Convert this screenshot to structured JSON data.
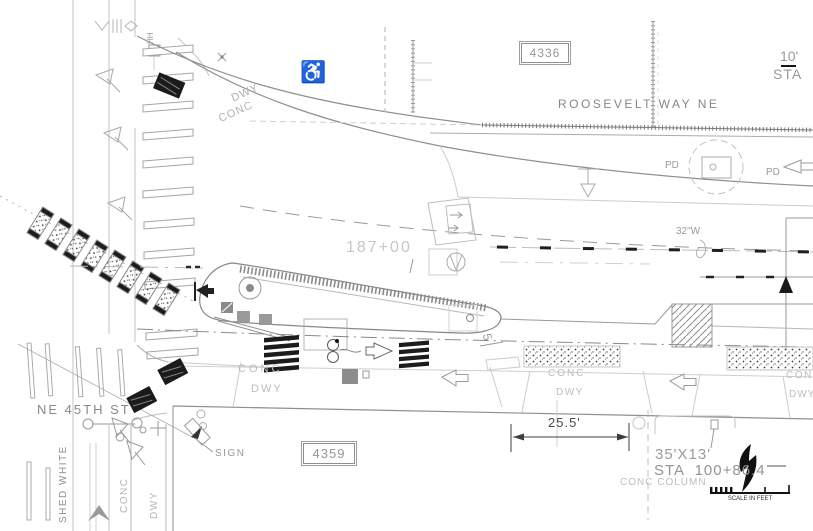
{
  "parcels": {
    "north_lot": "4336",
    "south_lot": "4359"
  },
  "streets": {
    "east_west": "ROOSEVELT WAY NE",
    "south": "NE 45TH ST"
  },
  "stations": {
    "centerline": "187+00",
    "column": "STA  100+86.4"
  },
  "dimensions": {
    "driveway": "25.5'",
    "column_size": "35'X13'",
    "offset_top_right": "10'",
    "sta_top_right": "STA",
    "island_width": "5"
  },
  "utilities": {
    "water_main": "32\"W",
    "handhole": "HH",
    "power_pd": "PD"
  },
  "surfaces": {
    "conc": "CONC",
    "dwy": "DWY",
    "conc_column": "CONC COLUMN"
  },
  "annotations": {
    "sign": "SIGN",
    "pavement_marking_vertical": "SHED WHITE"
  },
  "scale_bar": {
    "caption": "SCALE IN FEET"
  },
  "icons": {
    "accessible_ramp": "♿"
  },
  "colors": {
    "ink": "#1a1a1a",
    "line_mid": "#9a9a9a",
    "line_light": "#c9c9c9",
    "text_gray": "#9a9a9a"
  }
}
